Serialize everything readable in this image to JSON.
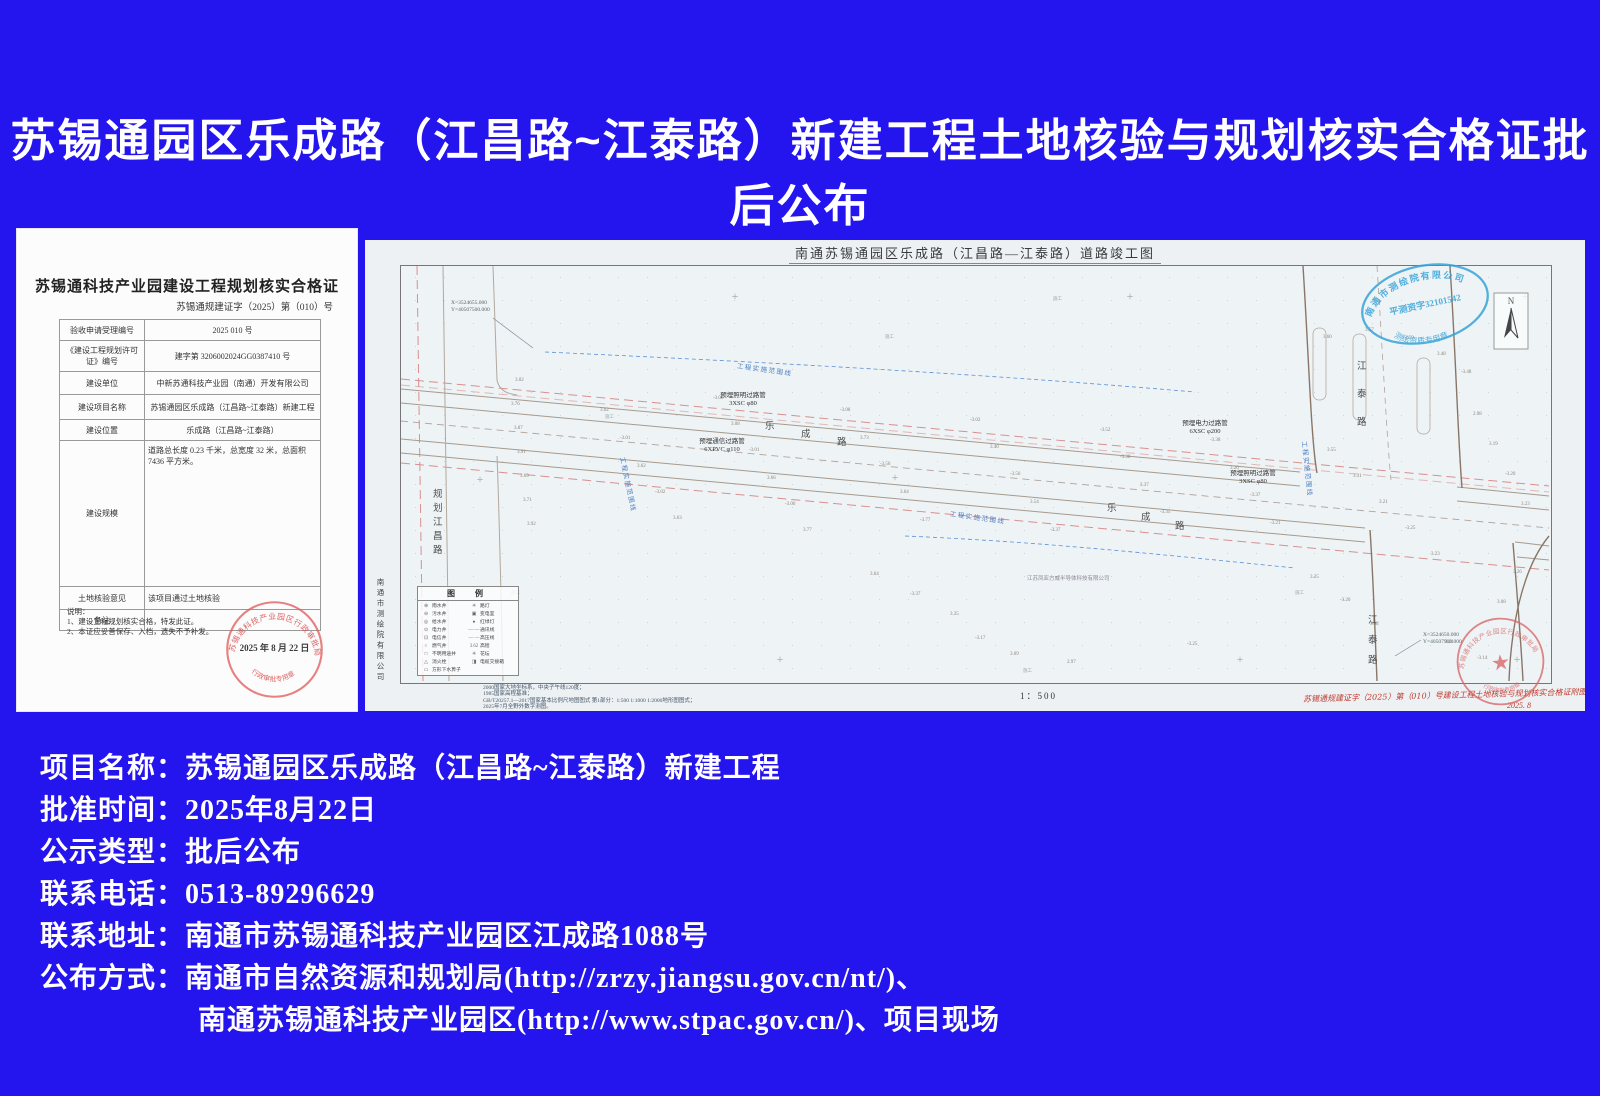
{
  "page": {
    "title": "苏锡通园区乐成路（江昌路~江泰路）新建工程土地核验与规划核实合格证批后公布",
    "background_color": "#2414EE"
  },
  "certificate": {
    "title": "苏锡通科技产业园建设工程规划核实合格证",
    "doc_number": "苏锡通规建证字（2025）第（010）号",
    "rows": [
      {
        "label": "验收申请受理编号",
        "value": "2025  010 号"
      },
      {
        "label": "《建设工程规划许可证》编号",
        "value": "建字第 3206002024GG0387410 号"
      },
      {
        "label": "建设单位",
        "value": "中新苏通科技产业园（南通）开发有限公司"
      },
      {
        "label": "建设项目名称",
        "value": "苏锡通园区乐成路（江昌路~江泰路）新建工程"
      },
      {
        "label": "建设位置",
        "value": "乐成路（江昌路~江泰路）"
      },
      {
        "label": "建设规模",
        "value": "道路总长度 0.23 千米，总宽度 32 米，总面积 7436 平方米。"
      },
      {
        "label": "土地核验意见",
        "value": "该项目通过土地核验"
      },
      {
        "label": "备注",
        "value": ""
      }
    ],
    "notes_title": "说明：",
    "notes": [
      "1、建设工程规划核实合格，特发此证。",
      "2、本证应妥善保存、入档，遗失不予补发。"
    ],
    "stamp": {
      "arc_top": "苏锡通科技产业园区行政审批局",
      "date": "2025 年 8 月 22 日",
      "arc_bottom": "行政审批专用章"
    }
  },
  "drawing": {
    "title": "南通苏锡通园区乐成路（江昌路—江泰路）道路竣工图",
    "surveyor_vertical": "南通市测绘院有限公司",
    "blue_stamp": {
      "arc_top": "南通市测绘院有限公司",
      "middle": "平测资字32101542",
      "arc_bottom": "测绘资质专用章"
    },
    "red_stamp": {
      "arc_top": "苏锡通科技产业园区行政审批局",
      "arc_bottom": "行政审批专用章",
      "star": "★"
    },
    "north_label": "N",
    "coords_topleft_x": "X=3524655.000",
    "coords_topleft_y": "Y=40507500.000",
    "coords_bottomright_x": "X=3524650.000",
    "coords_bottomright_y": "Y=40507900.000",
    "scale": "1：500",
    "company_label": "江苏凤亚方威半导体科技有限公司",
    "red_note": "苏锡通规建证字（2025）第（010）号建设工程土地核验与规划核实合格证附图",
    "red_note_date": "2025. 8",
    "range_line_text": "工程实施范围线",
    "construction_text": "施工",
    "legend": {
      "title": "图　例",
      "left": [
        {
          "sym": "⊕",
          "label": "雨水井"
        },
        {
          "sym": "⊖",
          "label": "污水井"
        },
        {
          "sym": "◎",
          "label": "给水井"
        },
        {
          "sym": "⊙",
          "label": "电力井"
        },
        {
          "sym": "⊡",
          "label": "电信井"
        },
        {
          "sym": "○",
          "label": "燃气井"
        },
        {
          "sym": "□",
          "label": "不明用途井"
        },
        {
          "sym": "△",
          "label": "消火栓"
        },
        {
          "sym": "▭",
          "label": "方形下水箅子"
        }
      ],
      "right": [
        {
          "sym": "☀",
          "label": "路灯"
        },
        {
          "sym": "▣",
          "label": "变电室"
        },
        {
          "sym": "●",
          "label": "红绿灯"
        },
        {
          "sym": "—·—",
          "label": "通讯线"
        },
        {
          "sym": "— —",
          "label": "高压线"
        },
        {
          "sym": "3.62",
          "label": "高程"
        },
        {
          "sym": "✳",
          "label": "花坛"
        },
        {
          "sym": "◨",
          "label": "电缆交接箱"
        }
      ]
    },
    "map_notes": [
      "2000国家大地坐标系，中央子午线120度；",
      "1985国家高程基准；",
      "GB/T20257.1—2017国家基本比例尺地图图式 第1部分：1:500 1:1000 1:2000地形图图式；",
      "2025年7月全野外数字测图。"
    ],
    "pipe_labels": [
      {
        "line1": "预埋照明过路管",
        "line2": "3XSC φ80",
        "x": 378,
        "y": 152
      },
      {
        "line1": "预埋通信过路管",
        "line2": "6XPVC φ110",
        "x": 357,
        "y": 198
      },
      {
        "line1": "预埋电力过路管",
        "line2": "6XSC φ200",
        "x": 840,
        "y": 180
      },
      {
        "line1": "预埋照明过路管",
        "line2": "3XSC φ80",
        "x": 888,
        "y": 230
      }
    ],
    "range_labels": [
      {
        "x": 372,
        "y": 120,
        "rot": 8
      },
      {
        "x": 258,
        "y": 212,
        "rot": 78
      },
      {
        "x": 585,
        "y": 268,
        "rot": 8
      },
      {
        "x": 940,
        "y": 196,
        "rot": 84
      }
    ],
    "road_marks": [
      {
        "ch": "乐",
        "x": 400,
        "y": 178
      },
      {
        "ch": "成",
        "x": 436,
        "y": 186
      },
      {
        "ch": "路",
        "x": 472,
        "y": 194
      },
      {
        "ch": "乐",
        "x": 742,
        "y": 260
      },
      {
        "ch": "成",
        "x": 776,
        "y": 269
      },
      {
        "ch": "路",
        "x": 810,
        "y": 278
      },
      {
        "ch": "江",
        "x": 992,
        "y": 118
      },
      {
        "ch": "泰",
        "x": 992,
        "y": 146
      },
      {
        "ch": "路",
        "x": 992,
        "y": 174
      },
      {
        "ch": "江",
        "x": 1003,
        "y": 372
      },
      {
        "ch": "泰",
        "x": 1003,
        "y": 392
      },
      {
        "ch": "路",
        "x": 1003,
        "y": 412
      },
      {
        "ch": "规",
        "x": 68,
        "y": 246
      },
      {
        "ch": "划",
        "x": 68,
        "y": 260
      },
      {
        "ch": "江",
        "x": 68,
        "y": 274
      },
      {
        "ch": "昌",
        "x": 68,
        "y": 288
      },
      {
        "ch": "路",
        "x": 68,
        "y": 302
      }
    ],
    "construction_marks": [
      {
        "x": 688,
        "y": 56
      },
      {
        "x": 520,
        "y": 94
      },
      {
        "x": 240,
        "y": 174
      },
      {
        "x": 146,
        "y": 350
      },
      {
        "x": 930,
        "y": 350
      },
      {
        "x": 658,
        "y": 428
      }
    ],
    "crosses": [
      {
        "x": 370,
        "y": 57
      },
      {
        "x": 765,
        "y": 57
      },
      {
        "x": 1160,
        "y": 57
      },
      {
        "x": 115,
        "y": 240
      },
      {
        "x": 530,
        "y": 238
      },
      {
        "x": 415,
        "y": 420
      },
      {
        "x": 875,
        "y": 420
      },
      {
        "x": 1152,
        "y": 420
      }
    ],
    "elevation_points": [
      {
        "x": 150,
        "y": 138,
        "v": "3.02"
      },
      {
        "x": 146,
        "y": 162,
        "v": "3.76"
      },
      {
        "x": 149,
        "y": 186,
        "v": "3.87"
      },
      {
        "x": 152,
        "y": 210,
        "v": "3.91"
      },
      {
        "x": 155,
        "y": 234,
        "v": "3.69"
      },
      {
        "x": 158,
        "y": 258,
        "v": "3.71"
      },
      {
        "x": 162,
        "y": 282,
        "v": "3.92"
      },
      {
        "x": 235,
        "y": 168,
        "v": "3.02"
      },
      {
        "x": 255,
        "y": 196,
        "v": "-3.01"
      },
      {
        "x": 272,
        "y": 224,
        "v": "3.62"
      },
      {
        "x": 290,
        "y": 250,
        "v": "-3.02"
      },
      {
        "x": 308,
        "y": 276,
        "v": "3.63"
      },
      {
        "x": 348,
        "y": 156,
        "v": "-3.08"
      },
      {
        "x": 366,
        "y": 182,
        "v": "3.08"
      },
      {
        "x": 384,
        "y": 208,
        "v": "-3.01"
      },
      {
        "x": 402,
        "y": 236,
        "v": "3.66"
      },
      {
        "x": 420,
        "y": 262,
        "v": "-3.06"
      },
      {
        "x": 438,
        "y": 288,
        "v": "3.77"
      },
      {
        "x": 475,
        "y": 168,
        "v": "-3.08"
      },
      {
        "x": 495,
        "y": 196,
        "v": "3.73"
      },
      {
        "x": 515,
        "y": 222,
        "v": "-3.56"
      },
      {
        "x": 535,
        "y": 250,
        "v": "3.64"
      },
      {
        "x": 555,
        "y": 278,
        "v": "-3.77"
      },
      {
        "x": 605,
        "y": 178,
        "v": "-3.02"
      },
      {
        "x": 625,
        "y": 205,
        "v": "3.40"
      },
      {
        "x": 645,
        "y": 232,
        "v": "-3.56"
      },
      {
        "x": 665,
        "y": 260,
        "v": "3.54"
      },
      {
        "x": 685,
        "y": 288,
        "v": "-3.37"
      },
      {
        "x": 735,
        "y": 188,
        "v": "-3.52"
      },
      {
        "x": 755,
        "y": 215,
        "v": "-3.38"
      },
      {
        "x": 775,
        "y": 243,
        "v": "3.37"
      },
      {
        "x": 795,
        "y": 270,
        "v": "-3.35"
      },
      {
        "x": 845,
        "y": 198,
        "v": "-3.38"
      },
      {
        "x": 865,
        "y": 226,
        "v": "3.20"
      },
      {
        "x": 885,
        "y": 253,
        "v": "-3.37"
      },
      {
        "x": 905,
        "y": 281,
        "v": "-3.21"
      },
      {
        "x": 958,
        "y": 95,
        "v": "3.60"
      },
      {
        "x": 1000,
        "y": 88,
        "v": "3.57"
      },
      {
        "x": 1040,
        "y": 96,
        "v": "3.59"
      },
      {
        "x": 1072,
        "y": 112,
        "v": "3.48"
      },
      {
        "x": 1096,
        "y": 130,
        "v": "-3.48"
      },
      {
        "x": 962,
        "y": 208,
        "v": "3.55"
      },
      {
        "x": 988,
        "y": 234,
        "v": "3.31"
      },
      {
        "x": 1014,
        "y": 260,
        "v": "3.21"
      },
      {
        "x": 1040,
        "y": 286,
        "v": "-3.25"
      },
      {
        "x": 1066,
        "y": 312,
        "v": "3.23"
      },
      {
        "x": 945,
        "y": 335,
        "v": "3.25"
      },
      {
        "x": 975,
        "y": 358,
        "v": "-3.20"
      },
      {
        "x": 1005,
        "y": 382,
        "v": "3.42"
      },
      {
        "x": 1108,
        "y": 172,
        "v": "2.98"
      },
      {
        "x": 1124,
        "y": 202,
        "v": "3.19"
      },
      {
        "x": 1140,
        "y": 232,
        "v": "-3.20"
      },
      {
        "x": 1156,
        "y": 262,
        "v": "3.23"
      },
      {
        "x": 1148,
        "y": 330,
        "v": "3.26"
      },
      {
        "x": 1132,
        "y": 360,
        "v": "3.08"
      },
      {
        "x": 1080,
        "y": 400,
        "v": "3.21"
      },
      {
        "x": 1112,
        "y": 416,
        "v": "-3.14"
      },
      {
        "x": 610,
        "y": 396,
        "v": "-3.17"
      },
      {
        "x": 645,
        "y": 412,
        "v": "3.09"
      },
      {
        "x": 702,
        "y": 420,
        "v": "2.97"
      },
      {
        "x": 822,
        "y": 402,
        "v": "-3.25"
      },
      {
        "x": 505,
        "y": 332,
        "v": "3.64"
      },
      {
        "x": 545,
        "y": 352,
        "v": "-3.37"
      },
      {
        "x": 585,
        "y": 372,
        "v": "3.35"
      }
    ]
  },
  "info": {
    "lines": [
      {
        "label": "项目名称：",
        "value": "苏锡通园区乐成路（江昌路~江泰路）新建工程"
      },
      {
        "label": "批准时间：",
        "value": "2025年8月22日"
      },
      {
        "label": "公示类型：",
        "value": "批后公布"
      },
      {
        "label": "联系电话：",
        "value": "0513-89296629"
      },
      {
        "label": "联系地址：",
        "value": "南通市苏锡通科技产业园区江成路1088号"
      },
      {
        "label": "公布方式：",
        "value": "南通市自然资源和规划局(http://zrzy.jiangsu.gov.cn/nt/)、"
      },
      {
        "label": "",
        "value": "南通苏锡通科技产业园区(http://www.stpac.gov.cn/)、项目现场"
      }
    ]
  }
}
